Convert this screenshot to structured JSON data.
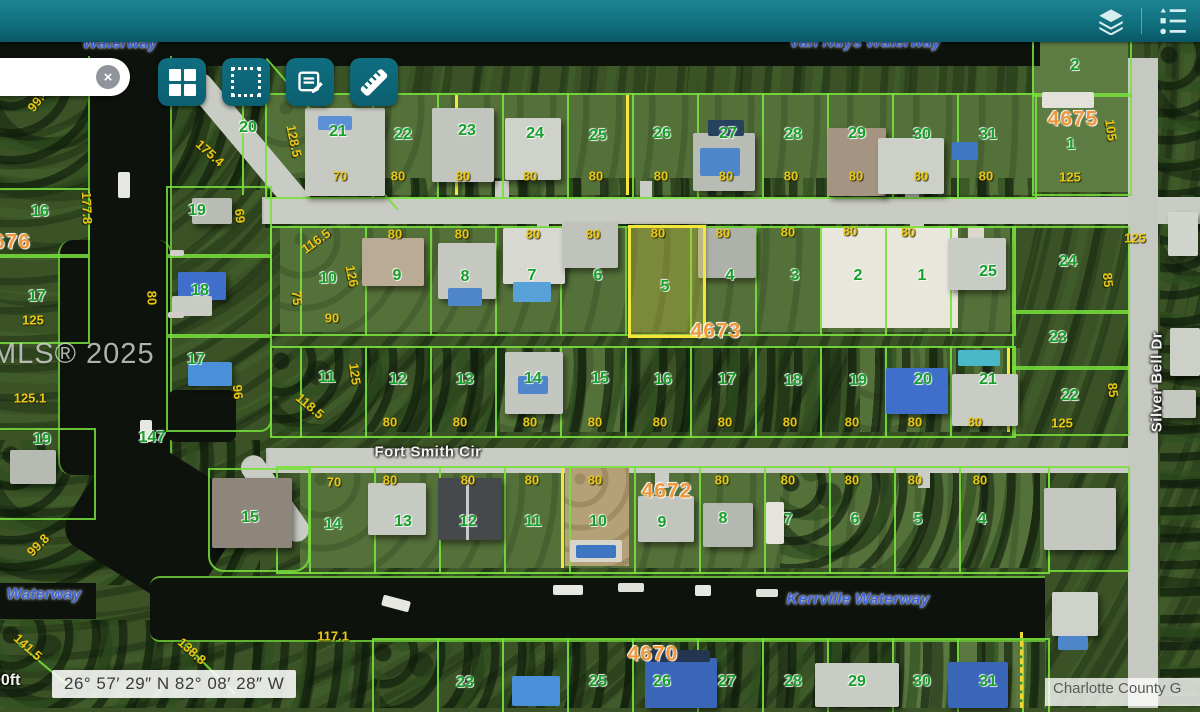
{
  "ui": {
    "header": {
      "accent_color": "#11707e"
    },
    "search": {
      "value": "",
      "clear_icon": "×"
    },
    "toolbar": {
      "buttons": [
        {
          "icon": "grid-layout-icon"
        },
        {
          "icon": "marquee-select-icon"
        },
        {
          "icon": "notes-edit-icon"
        },
        {
          "icon": "measure-ruler-icon"
        }
      ]
    },
    "header_icons": [
      {
        "icon": "layers-icon"
      },
      {
        "icon": "legend-list-icon"
      }
    ],
    "statusbar": {
      "scale_label": "00ft",
      "coordinates": "26° 57′ 29″ N 82° 08′ 28″ W",
      "attribution": "Charlotte County G"
    },
    "watermark": "MLS® 2025"
  },
  "map": {
    "selected_lot": {
      "number": "5",
      "block": "4673",
      "highlight_color": "#f5e63c"
    },
    "colors": {
      "lot_number": "#17a02b",
      "dimension": "#e9c714",
      "block_number": "#f0973c",
      "waterway": "#3c62d9",
      "parcel_line": "#78e13c"
    },
    "labels": {
      "streets": [
        [
          "Fort Smith Cir",
          428,
          452,
          0
        ],
        [
          "Silver Bell Dr",
          1157,
          382,
          -90
        ]
      ],
      "waterways": [
        [
          "Van Nuys Waterway",
          865,
          43,
          0
        ],
        [
          "Waterway",
          120,
          44,
          0
        ],
        [
          "Kerrville Waterway",
          858,
          600,
          0
        ],
        [
          "Waterway",
          44,
          595,
          0
        ]
      ],
      "blocks": [
        [
          "4675",
          1073,
          119,
          0
        ],
        [
          "676",
          12,
          242,
          0
        ],
        [
          "4673",
          716,
          331,
          0
        ],
        [
          "4672",
          667,
          491,
          0
        ],
        [
          "4670",
          653,
          654,
          0
        ]
      ],
      "lots": [
        [
          "20",
          248,
          128
        ],
        [
          "21",
          338,
          132
        ],
        [
          "22",
          403,
          135
        ],
        [
          "23",
          467,
          131
        ],
        [
          "24",
          535,
          134
        ],
        [
          "25",
          598,
          136
        ],
        [
          "26",
          662,
          134
        ],
        [
          "27",
          728,
          134
        ],
        [
          "28",
          793,
          135
        ],
        [
          "29",
          857,
          134
        ],
        [
          "30",
          922,
          135
        ],
        [
          "31",
          988,
          135
        ],
        [
          "2",
          1075,
          66
        ],
        [
          "1",
          1071,
          145
        ],
        [
          "10",
          328,
          279
        ],
        [
          "9",
          397,
          276
        ],
        [
          "8",
          465,
          277
        ],
        [
          "7",
          532,
          276
        ],
        [
          "6",
          598,
          276
        ],
        [
          "5",
          665,
          287
        ],
        [
          "4",
          730,
          276
        ],
        [
          "3",
          795,
          276
        ],
        [
          "2",
          858,
          276
        ],
        [
          "1",
          922,
          276
        ],
        [
          "25",
          988,
          272
        ],
        [
          "24",
          1068,
          262
        ],
        [
          "11",
          327,
          378
        ],
        [
          "12",
          398,
          380
        ],
        [
          "13",
          465,
          380
        ],
        [
          "14",
          533,
          379
        ],
        [
          "15",
          600,
          379
        ],
        [
          "16",
          663,
          380
        ],
        [
          "17",
          727,
          380
        ],
        [
          "18",
          793,
          381
        ],
        [
          "19",
          858,
          381
        ],
        [
          "20",
          923,
          380
        ],
        [
          "21",
          988,
          380
        ],
        [
          "23",
          1058,
          338
        ],
        [
          "22",
          1070,
          396
        ],
        [
          "16",
          40,
          212
        ],
        [
          "19",
          197,
          211
        ],
        [
          "18",
          200,
          291
        ],
        [
          "17",
          37,
          297
        ],
        [
          "17",
          196,
          360
        ],
        [
          "19",
          42,
          440
        ],
        [
          "147",
          152,
          438
        ],
        [
          "15",
          250,
          518
        ],
        [
          "14",
          333,
          525
        ],
        [
          "13",
          403,
          522
        ],
        [
          "12",
          468,
          522
        ],
        [
          "11",
          533,
          522
        ],
        [
          "10",
          598,
          522
        ],
        [
          "9",
          662,
          523
        ],
        [
          "8",
          723,
          519
        ],
        [
          "7",
          788,
          520
        ],
        [
          "6",
          855,
          520
        ],
        [
          "5",
          918,
          520
        ],
        [
          "4",
          982,
          520
        ],
        [
          "23",
          465,
          683
        ],
        [
          "25",
          598,
          682
        ],
        [
          "26",
          662,
          682
        ],
        [
          "27",
          727,
          682
        ],
        [
          "28",
          793,
          682
        ],
        [
          "29",
          857,
          682
        ],
        [
          "30",
          922,
          682
        ],
        [
          "31",
          988,
          682
        ]
      ],
      "dims": [
        [
          "99.4",
          38,
          100,
          -52
        ],
        [
          "175.4",
          210,
          153,
          42
        ],
        [
          "128.5",
          294,
          141,
          78
        ],
        [
          "177.8",
          87,
          208,
          88
        ],
        [
          "69",
          240,
          216,
          85
        ],
        [
          "70",
          340,
          176,
          0
        ],
        [
          "80",
          398,
          176,
          0
        ],
        [
          "80",
          463,
          176,
          0
        ],
        [
          "80",
          530,
          176,
          0
        ],
        [
          "80",
          596,
          176,
          0
        ],
        [
          "80",
          661,
          176,
          0
        ],
        [
          "80",
          726,
          176,
          0
        ],
        [
          "80",
          791,
          176,
          0
        ],
        [
          "80",
          856,
          176,
          0
        ],
        [
          "80",
          921,
          176,
          0
        ],
        [
          "80",
          986,
          176,
          0
        ],
        [
          "105",
          1111,
          130,
          82
        ],
        [
          "125",
          1070,
          177,
          0
        ],
        [
          "125",
          1135,
          238,
          0
        ],
        [
          "80",
          395,
          234,
          0
        ],
        [
          "80",
          462,
          234,
          0
        ],
        [
          "80",
          533,
          234,
          0
        ],
        [
          "80",
          593,
          234,
          0
        ],
        [
          "80",
          658,
          233,
          0
        ],
        [
          "80",
          723,
          233,
          0
        ],
        [
          "80",
          788,
          232,
          0
        ],
        [
          "80",
          850,
          231,
          0
        ],
        [
          "80",
          908,
          232,
          0
        ],
        [
          "116.5",
          316,
          241,
          -36
        ],
        [
          "126",
          352,
          276,
          78
        ],
        [
          "75",
          297,
          298,
          84
        ],
        [
          "90",
          332,
          318,
          0
        ],
        [
          "80",
          152,
          298,
          88
        ],
        [
          "125",
          33,
          320,
          0
        ],
        [
          "125.1",
          30,
          398,
          0
        ],
        [
          "96",
          238,
          392,
          84
        ],
        [
          "125",
          355,
          374,
          82
        ],
        [
          "118.5",
          310,
          406,
          40
        ],
        [
          "85",
          1108,
          280,
          84
        ],
        [
          "85",
          1113,
          390,
          84
        ],
        [
          "80",
          390,
          422,
          0
        ],
        [
          "80",
          460,
          422,
          0
        ],
        [
          "80",
          530,
          422,
          0
        ],
        [
          "80",
          595,
          422,
          0
        ],
        [
          "80",
          660,
          422,
          0
        ],
        [
          "80",
          725,
          422,
          0
        ],
        [
          "80",
          790,
          422,
          0
        ],
        [
          "80",
          852,
          422,
          0
        ],
        [
          "80",
          915,
          422,
          0
        ],
        [
          "80",
          975,
          422,
          0
        ],
        [
          "125",
          1062,
          423,
          0
        ],
        [
          "70",
          334,
          482,
          0
        ],
        [
          "80",
          390,
          480,
          0
        ],
        [
          "80",
          468,
          480,
          0
        ],
        [
          "80",
          532,
          480,
          0
        ],
        [
          "80",
          595,
          480,
          0
        ],
        [
          "80",
          722,
          480,
          0
        ],
        [
          "80",
          788,
          480,
          0
        ],
        [
          "80",
          852,
          480,
          0
        ],
        [
          "80",
          915,
          480,
          0
        ],
        [
          "80",
          980,
          480,
          0
        ],
        [
          "99.8",
          38,
          545,
          -45
        ],
        [
          "117.1",
          333,
          636,
          0
        ],
        [
          "141.5",
          28,
          647,
          42
        ],
        [
          "138.8",
          192,
          651,
          42
        ]
      ]
    }
  }
}
